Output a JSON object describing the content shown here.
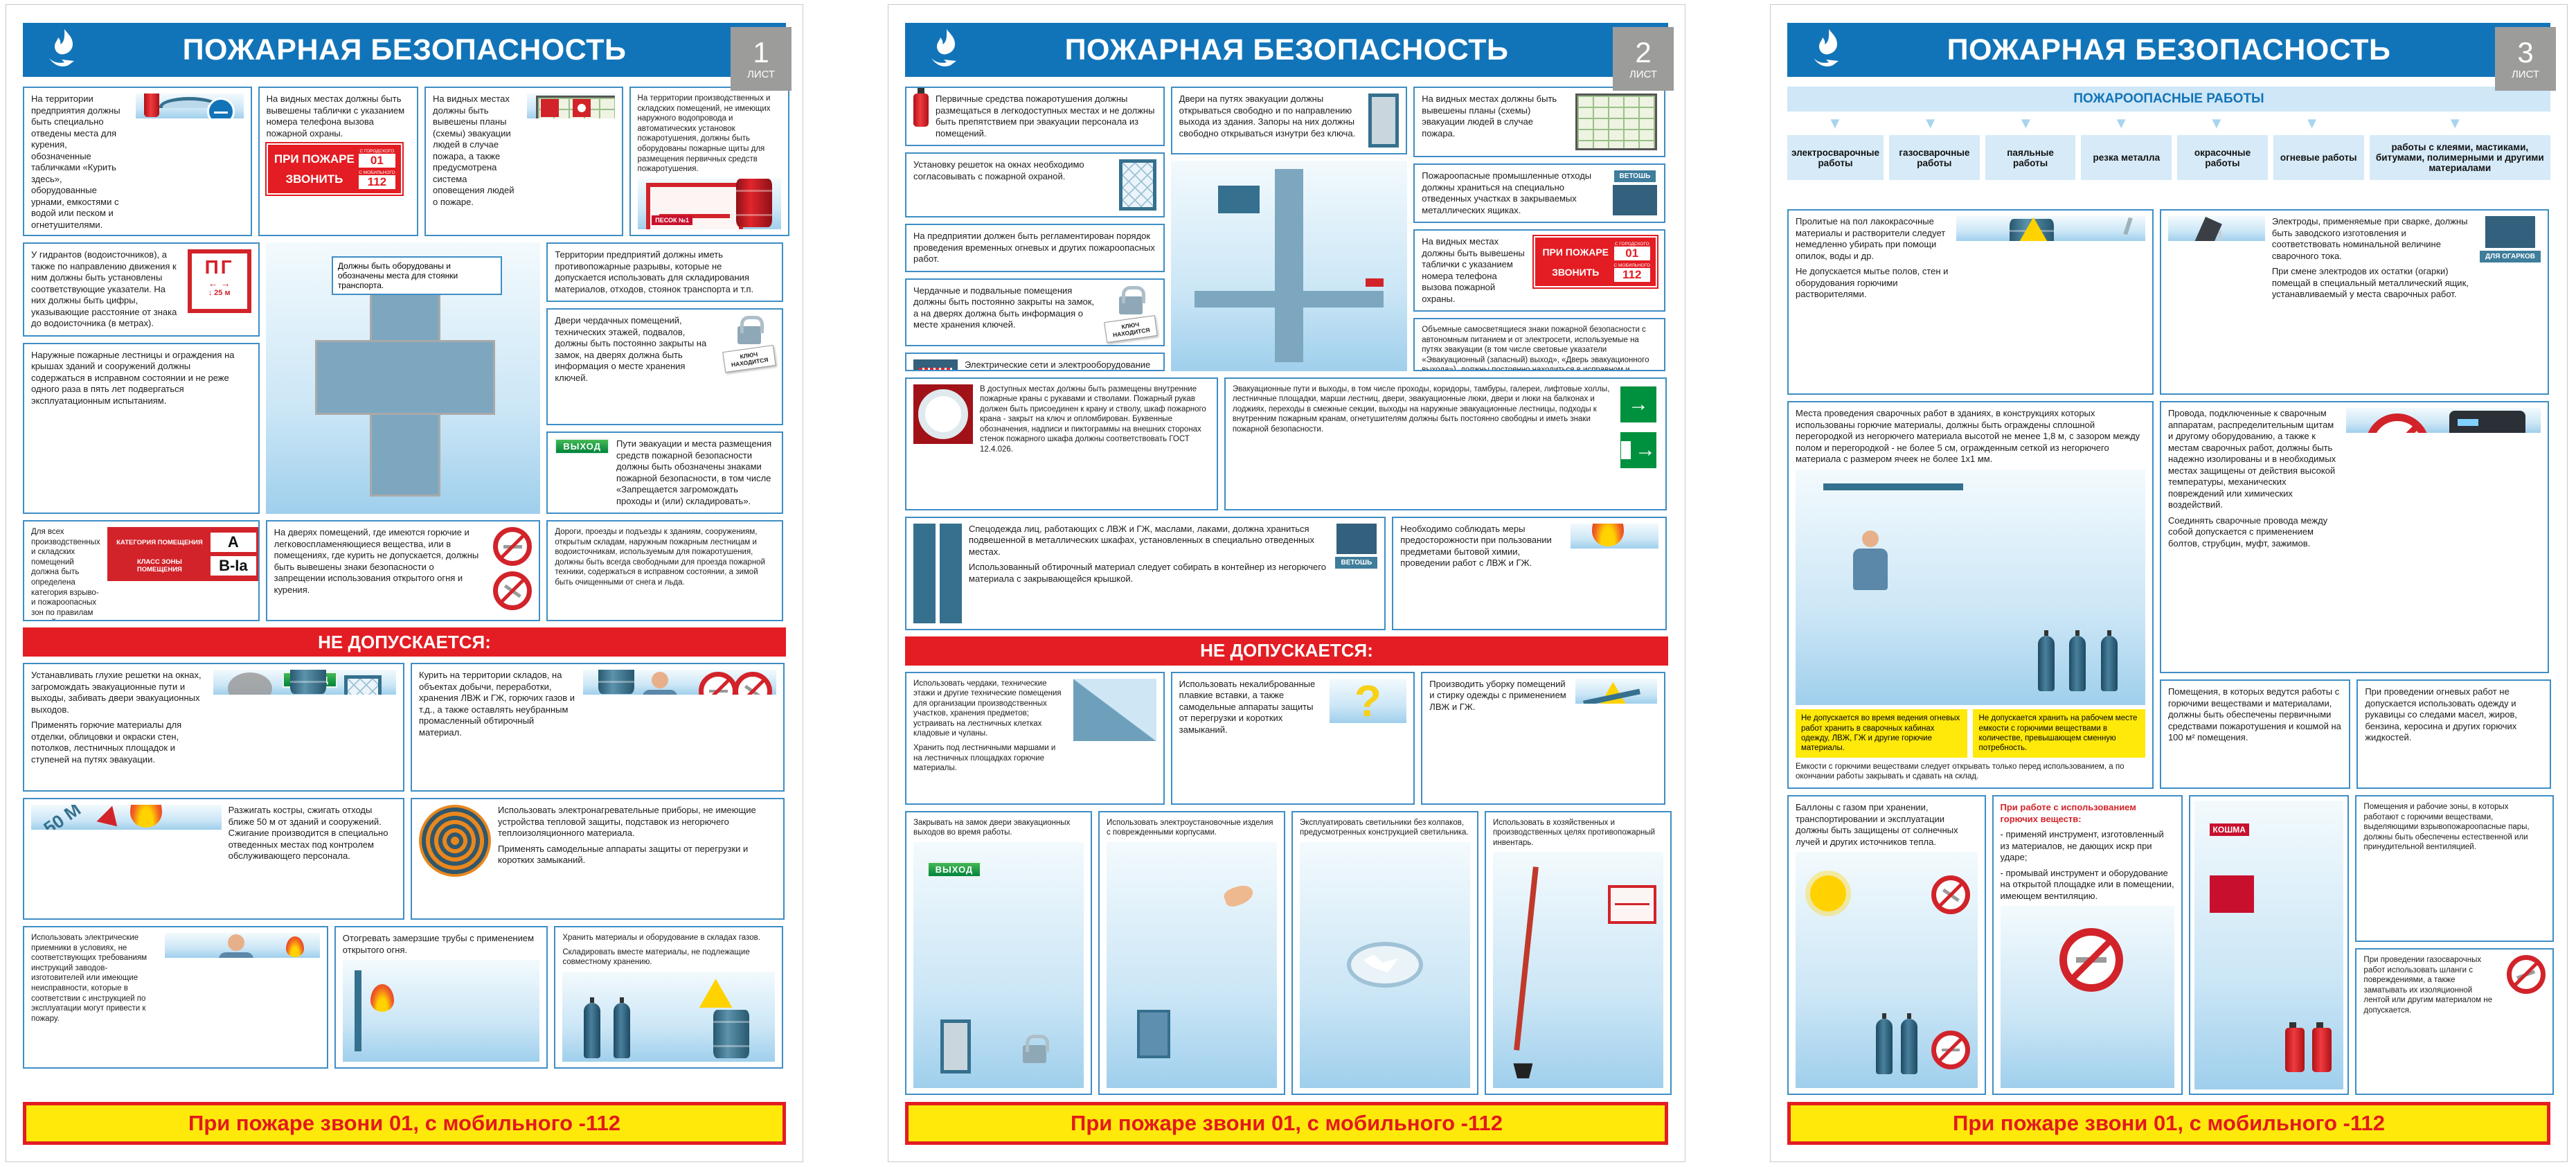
{
  "signs": {
    "call_title": "ПРИ ПОЖАРЕ",
    "call_action": "ЗВОНИТЬ",
    "from_city": "С ГОРОДСКОГО",
    "num_city": "01",
    "from_mobile": "С МОБИЛЬНОГО",
    "num_mobile": "112",
    "hydrant": "ПГ",
    "hydrant_arrows": "← →",
    "hydrant_dist": "↓ 25 м",
    "category_label": "КАТЕГОРИЯ ПОМЕЩЕНИЯ",
    "category_value": "А",
    "zone_label": "КЛАСС ЗОНЫ ПОМЕЩЕНИЯ",
    "zone_value": "В-Iа",
    "key_tag": "КЛЮЧ НАХОДИТСЯ",
    "exit": "ВЫХОД",
    "rags": "ВЕТОШЬ",
    "sand": "ПЕСОК №1",
    "stubs": "ДЛЯ ОГАРКОВ",
    "koshma": "КОШМА",
    "dist50": "50 М",
    "evac_arrow": "→"
  },
  "footer": "При пожаре звони 01, с мобильного -112",
  "not_allowed_label": "НЕ ДОПУСКАЕТСЯ:",
  "posters": [
    {
      "title": "ПОЖАРНАЯ БЕЗОПАСНОСТЬ",
      "sheet": "1",
      "sheet_word": "ЛИСТ",
      "rules": [
        "На территории предприятия должны быть специально отведены места для курения, обозначенные табличками «Курить здесь», оборудованные урнами, емкостями с водой или песком и огнетушителями.",
        "На видных местах должны быть вывешены таблички с указанием номера телефона вызова пожарной охраны.",
        "На видных местах должны быть вывешены планы (схемы) эвакуации людей в случае пожара, а также предусмотрена система оповещения людей о пожаре.",
        "На территории производственных и складских помещений, не имеющих наружного водопровода и автоматических установок пожаротушения, должны быть оборудованы пожарные щиты для размещения первичных средств пожаротушения.",
        "У гидрантов (водоисточников), а также по направлению движения к ним должны быть установлены соответствующие указатели. На них должны быть цифры, указывающие расстояние от знака до водоисточника (в метрах).",
        "Наружные пожарные лестницы и ограждения на крышах зданий и сооружений должны содержаться в исправном состоянии и не реже одного раза в пять лет подвергаться эксплуатационным испытаниям.",
        "Для всех производственных и складских помещений должна быть определена категория взрыво- и пожароопасных зон по правилам устройства электроустановок, которые надлежит обозначать на дверях помещений.",
        "Территории предприятий должны иметь противопожарные разрывы, которые не допускается использовать для складирования материалов, отходов, стоянок транспорта и т.п.",
        "Двери чердачных помещений, технических этажей, подвалов, должны быть постоянно закрыты на замок, на дверях должна быть информация о месте хранения ключей.",
        "Пути эвакуации и места размещения средств пожарной безопасности должны быть обозначены знаками пожарной безопасности, в том числе «Запрещается загромождать проходы и (или) складировать».",
        "Должны быть оборудованы и обозначены места для стоянки транспорта.",
        "На дверях помещений, где имеются горючие и легковоспламеняющиеся вещества, или в помещениях, где курить не допускается, должны быть вывешены знаки безопасности о запрещении использования открытого огня и курения.",
        "Дороги, проезды и подъезды к зданиям, сооружениям, открытым складам, наружным пожарным лестницам и водоисточникам, используемым для пожаротушения, должны быть всегда свободными для проезда пожарной техники, содержаться в исправном состоянии, а зимой быть очищенными от снега и льда."
      ],
      "not_allowed": [
        "Устанавливать глухие решетки на окнах, загромождать эвакуационные пути и выходы, забивать двери эвакуационных выходов.",
        "Применять горючие материалы для отделки, облицовки и окраски стен, потолков, лестничных площадок и ступеней на путях эвакуации.",
        "Курить на территории складов, на объектах добычи, переработки, хранения ЛВЖ и ГЖ, горючих газов и т.д., а также оставлять неубранным промасленный обтирочный материал.",
        "Разжигать костры, сжигать отходы ближе 50 м от зданий и сооружений. Сжигание производится в специально отведенных местах под контролем обслуживающего персонала.",
        "Использовать электронагревательные приборы, не имеющие устройства тепловой защиты, подставок из негорючего теплоизоляционного материала.",
        "Применять самодельные аппараты защиты от перегрузки и коротких замыканий.",
        "Использовать электрические приемники в условиях, не соответствующих требованиям инструкций заводов-изготовителей или имеющие неисправности, которые в соответствии с инструкцией по эксплуатации могут привести к пожару.",
        "Отогревать замерзшие трубы с применением открытого огня.",
        "Хранить материалы и оборудование в складах газов.",
        "Складировать вместе материалы, не подлежащие совместному хранению."
      ]
    },
    {
      "title": "ПОЖАРНАЯ БЕЗОПАСНОСТЬ",
      "sheet": "2",
      "sheet_word": "ЛИСТ",
      "rules": [
        "Первичные средства пожаротушения должны размещаться в легкодоступных местах и не должны быть препятствием при эвакуации персонала из помещений.",
        "Установку решеток на окнах необходимо согласовывать с пожарной охраной.",
        "На предприятии должен быть регламентирован порядок проведения временных огневых и других пожароопасных работ.",
        "Чердачные и подвальные помещения должны быть постоянно закрыты на замок, а на дверях должна быть информация о месте хранения ключей.",
        "Электрические сети и электрооборудование должны отвечать требованиям нормативно-технических документов.",
        "Двери на путях эвакуации должны открываться свободно и по направлению выхода из здания. Запоры на них должны свободно открываться изнутри без ключа.",
        "На видных местах должны быть вывешены планы (схемы) эвакуации людей в случае пожара.",
        "Пожароопасные промышленные отходы должны храниться на специально отведенных участках в закрываемых металлических ящиках.",
        "На видных местах должны быть вывешены таблички с указанием номера телефона вызова пожарной охраны.",
        "Объемные самосветящиеся знаки пожарной безопасности с автономным питанием и от электросети, используемые на путях эвакуации (в том числе световые указатели «Эвакуационный (запасный) выход», «Дверь эвакуационного выхода»), должны постоянно находиться в исправном и включенном состоянии.",
        "В доступных местах должны быть размещены внутренние пожарные краны с рукавами и стволами. Пожарный рукав должен быть присоединен к крану и стволу, шкаф пожарного крана - закрыт на ключ и опломбирован. Буквенные обозначения, надписи и пиктограммы на внешних сторонах стенок пожарного шкафа должны соответствовать ГОСТ 12.4.026.",
        "Эвакуационные пути и выходы, в том числе проходы, коридоры, тамбуры, галереи, лифтовые холлы, лестничные площадки, марши лестниц, двери, эвакуационные люки, двери и люки на балконах и лоджиях, переходы в смежные секции, выходы на наружные эвакуационные лестницы, подходы к внутренним пожарным кранам, огнетушителям должны быть постоянно свободны и иметь знаки пожарной безопасности.",
        "Спецодежда лиц, работающих с ЛВЖ и ГЖ, маслами, лаками, должна храниться подвешенной в металлических шкафах, установленных в специально отведенных местах.",
        "Использованный обтирочный материал следует собирать в контейнер из негорючего материала с закрывающейся крышкой.",
        "Необходимо соблюдать меры предосторожности при пользовании предметами бытовой химии, проведении работ с ЛВЖ и ГЖ."
      ],
      "not_allowed": [
        "Использовать чердаки, технические этажи и другие технические помещения для организации производственных участков, хранения предметов; устраивать на лестничных клетках кладовые и чуланы.",
        "Хранить под лестничными маршами и на лестничных площадках горючие материалы.",
        "Использовать некалиброванные плавкие вставки, а также самодельные аппараты защиты от перегрузки и коротких замыканий.",
        "Производить уборку помещений и стирку одежды с применением ЛВЖ и ГЖ.",
        "Закрывать на замок двери эвакуационных выходов во время работы.",
        "Использовать электроустановочные изделия с поврежденными корпусами.",
        "Эксплуатировать светильники без колпаков, предусмотренных конструкцией светильника.",
        "Использовать в хозяйственных и производственных целях противопожарный инвентарь."
      ]
    },
    {
      "title": "ПОЖАРНАЯ БЕЗОПАСНОСТЬ",
      "sheet": "3",
      "sheet_word": "ЛИСТ",
      "works_title": "ПОЖАРООПАСНЫЕ РАБОТЫ",
      "works": [
        "электросварочные работы",
        "газосварочные работы",
        "паяльные работы",
        "резка металла",
        "окрасочные работы",
        "огневые работы",
        "работы с клеями, мастиками, битумами, полимерными и другими материалами"
      ],
      "rules": [
        "Пролитые на пол лакокрасочные материалы и растворители следует немедленно убирать при помощи опилок, воды и др.",
        "Не допускается мытье полов, стен и оборудования горючими растворителями.",
        "Электроды, применяемые при сварке, должны быть заводского изготовления и соответствовать номинальной величине сварочного тока.",
        "При смене электродов их остатки (огарки) помещай в специальный металлический ящик, устанавливаемый у места сварочных работ.",
        "Места проведения сварочных работ в зданиях, в конструкциях которых использованы горючие материалы, должны быть ограждены сплошной перегородкой из негорючего материала высотой не менее 1,8 м, с зазором между полом и перегородкой - не более 5 см, огражденным сеткой из негорючего материала с размером ячеек не более 1х1 мм.",
        "Провода, подключенные к сварочным аппаратам, распределительным щитам и другому оборудованию, а также к местам сварочных работ, должны быть надежно изолированы и в необходимых местах защищены от действия высокой температуры, механических повреждений или химических воздействий.",
        "Соединять сварочные провода между собой допускается с применением болтов, струбцин, муфт, зажимов.",
        "Помещения, в которых ведутся работы с горючими веществами и материалами, должны быть обеспечены первичными средствами пожаротушения и кошмой на 100 м² помещения.",
        "При проведении огневых работ не допускается использовать одежду и рукавицы со следами масел, жиров, бензина, керосина и других горючих жидкостей."
      ],
      "notes": [
        "Не допускается во время ведения огневых работ хранить в сварочных кабинах одежду, ЛВЖ, ГЖ и другие горючие материалы.",
        "Не допускается хранить на рабочем месте емкости с горючими веществами в количестве, превышающем сменную потребность.",
        "Емкости с горючими веществами следует открывать только перед использованием, а по окончании работы закрывать и сдавать на склад."
      ],
      "bottom": [
        "Баллоны с газом при хранении, транспортировании и эксплуатации должны быть защищены от солнечных лучей и других источников тепла.",
        "При работе с использованием горючих веществ:",
        "- применяй инструмент, изготовленный из материалов, не дающих искр при ударе;",
        "- промывай инструмент и оборудование на открытой площадке или в помещении, имеющем вентиляцию.",
        "Помещения и рабочие зоны, в которых работают с горючими веществами, выделяющими взрывопожароопасные пары, должны быть обеспечены естественной или принудительной вентиляцией.",
        "При проведении газосварочных работ использовать шланги с повреждениями, а также заматывать их изоляционной лентой или другим материалом не допускается."
      ]
    }
  ]
}
